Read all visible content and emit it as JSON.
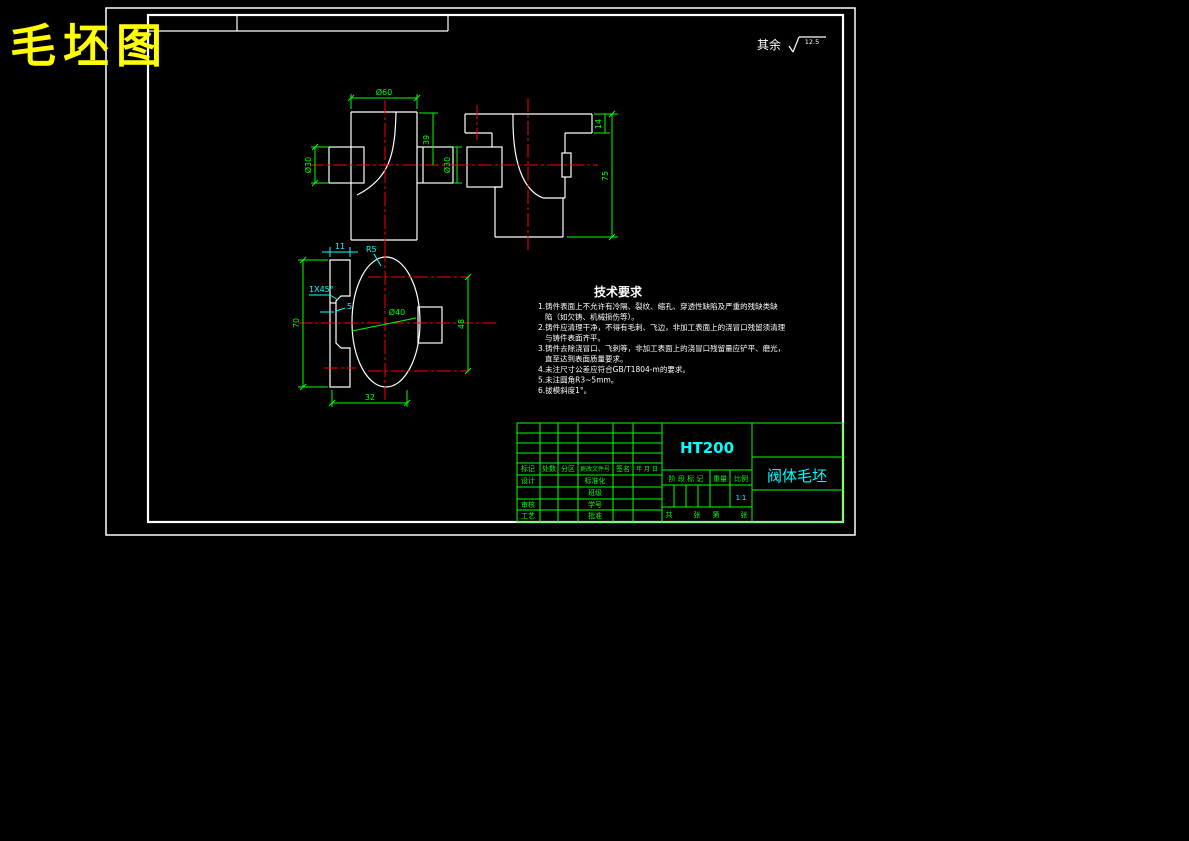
{
  "colors": {
    "background": "#000000",
    "frame": "#ffffff",
    "outline": "#ffffff",
    "centerline": "#ff0000",
    "dimension": "#00ff00",
    "auxiliary": "#00ffff",
    "title": "#ffff00",
    "table": "#00ff00",
    "value": "#00ffff"
  },
  "header": {
    "drawing_title": "毛坯图",
    "surface_prefix": "其余",
    "surface_roughness": "12.5"
  },
  "tech": {
    "heading": "技术要求",
    "lines": [
      {
        "t": "1.铸件表面上不允许有冷隔、裂纹、缩孔、穿透性缺陷及严重的残缺类缺"
      },
      {
        "t": "陷（如欠铸、机械损伤等）。"
      },
      {
        "t": "2.铸件应清理干净，不得有毛刺、飞边，非加工表面上的浇冒口残留须清理"
      },
      {
        "t": "与铸件表面齐平。"
      },
      {
        "t": "3.铸件去除浇冒口、飞刺等，非加工表面上的浇冒口残留量应铲平、磨光，"
      },
      {
        "t": "直至达到表面质量要求。"
      },
      {
        "t": "4.未注尺寸公差应符合GB/T1804-m的要求。"
      },
      {
        "t": "5.未注圆角R3~5mm。"
      },
      {
        "t": "6.拔模斜度1°。"
      }
    ]
  },
  "dims": {
    "front_top": "Ø60",
    "front_left": "Ø30",
    "front_right": "39",
    "front_boss": "Ø30",
    "side_top": "14",
    "side_height": "75",
    "bot_width": "11",
    "bot_radius": "R5",
    "bot_chamfer": "1X45°",
    "bot_step": "5",
    "bot_height": "70",
    "bot_bore": "Ø40",
    "bot_right": "48",
    "bot_bottom": "32"
  },
  "title_block": {
    "material": "HT200",
    "part_name": "阀体毛坯",
    "rev_headers": [
      "标记",
      "处数",
      "分区",
      "更改文件号",
      "签名",
      "年 月 日"
    ],
    "rows": {
      "design": "设计",
      "standard": "标准化",
      "class": "班级",
      "check": "审核",
      "number": "学号",
      "process": "工艺",
      "approve": "批准"
    },
    "stage_label": "阶 段 标 记",
    "weight_label": "重量",
    "scale_label": "比例",
    "scale_value": "1∶1",
    "sheet": [
      "共",
      "张",
      "第",
      "张"
    ]
  }
}
